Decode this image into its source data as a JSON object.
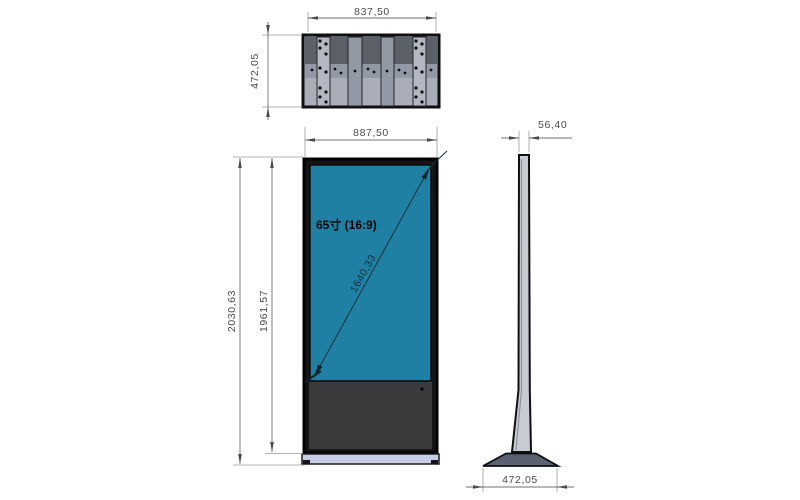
{
  "dims": {
    "top_view_width": "837,50",
    "top_view_depth": "472,05",
    "front_width": "887,50",
    "overall_height": "2030,63",
    "body_height": "1961,57",
    "screen_diagonal": "1640,33",
    "side_thickness": "56,40",
    "base_depth": "472,05"
  },
  "labels": {
    "screen_size": "65寸 (16:9)"
  },
  "colors": {
    "screen": "#1f80a4",
    "bezel": "#151517",
    "cabinet_panel": "#3b3b3d",
    "base_front": "#c6cde5",
    "base_side": "#5b6170",
    "metal_light": "#a9aeb9",
    "metal_mid": "#9298a4",
    "metal_strip": "#b2b7c1",
    "metal_dark": "#5c6169",
    "side_body": "#c8cbd2",
    "dim_text": "#4a4a4a"
  }
}
